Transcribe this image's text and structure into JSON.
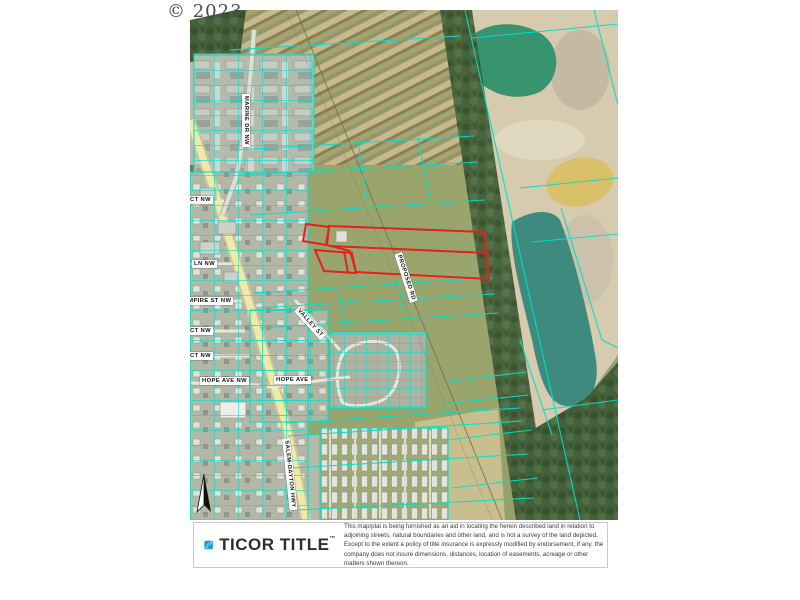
{
  "copyright": "© 2023",
  "map": {
    "labels": {
      "marine_dr": "MARINE DR NW",
      "ct_nw_upper": "CT NW",
      "ln_nw": "LN NW",
      "empire_st": "EMPIRE ST NW",
      "ct_nw_mid": "CT NW",
      "ct_nw_lower": "CT NW",
      "hope_ave_nw": "HOPE AVE NW",
      "hope_ave": "HOPE AVE",
      "valley_st": "VALLEY ST",
      "salem_dayton_hwy": "SALEM-DAYTON HWY",
      "proposed_rd": "PROPOSED RD"
    },
    "features": {
      "subject_parcel": "red outlined subject property",
      "parcel_lines": "cyan tax lot boundaries",
      "north_arrow": "north arrow"
    }
  },
  "footer": {
    "brand": "TICOR TITLE",
    "trademark": "™",
    "disclaimer": "This map/plat is being furnished as an aid in locating the herein described land in relation to adjoining streets, natural boundaries and other land, and is not a survey of the land depicted. Except to the extent a policy of title insurance is expressly modified by endorsement, if any, the company does not insure dimensions, distances, location of easements, acreage or other matters shown thereon."
  },
  "colors": {
    "parcel_boundary_cyan": "#00E0C8",
    "subject_parcel_red": "#E3221B",
    "brand_blue": "#1E9CD7"
  }
}
